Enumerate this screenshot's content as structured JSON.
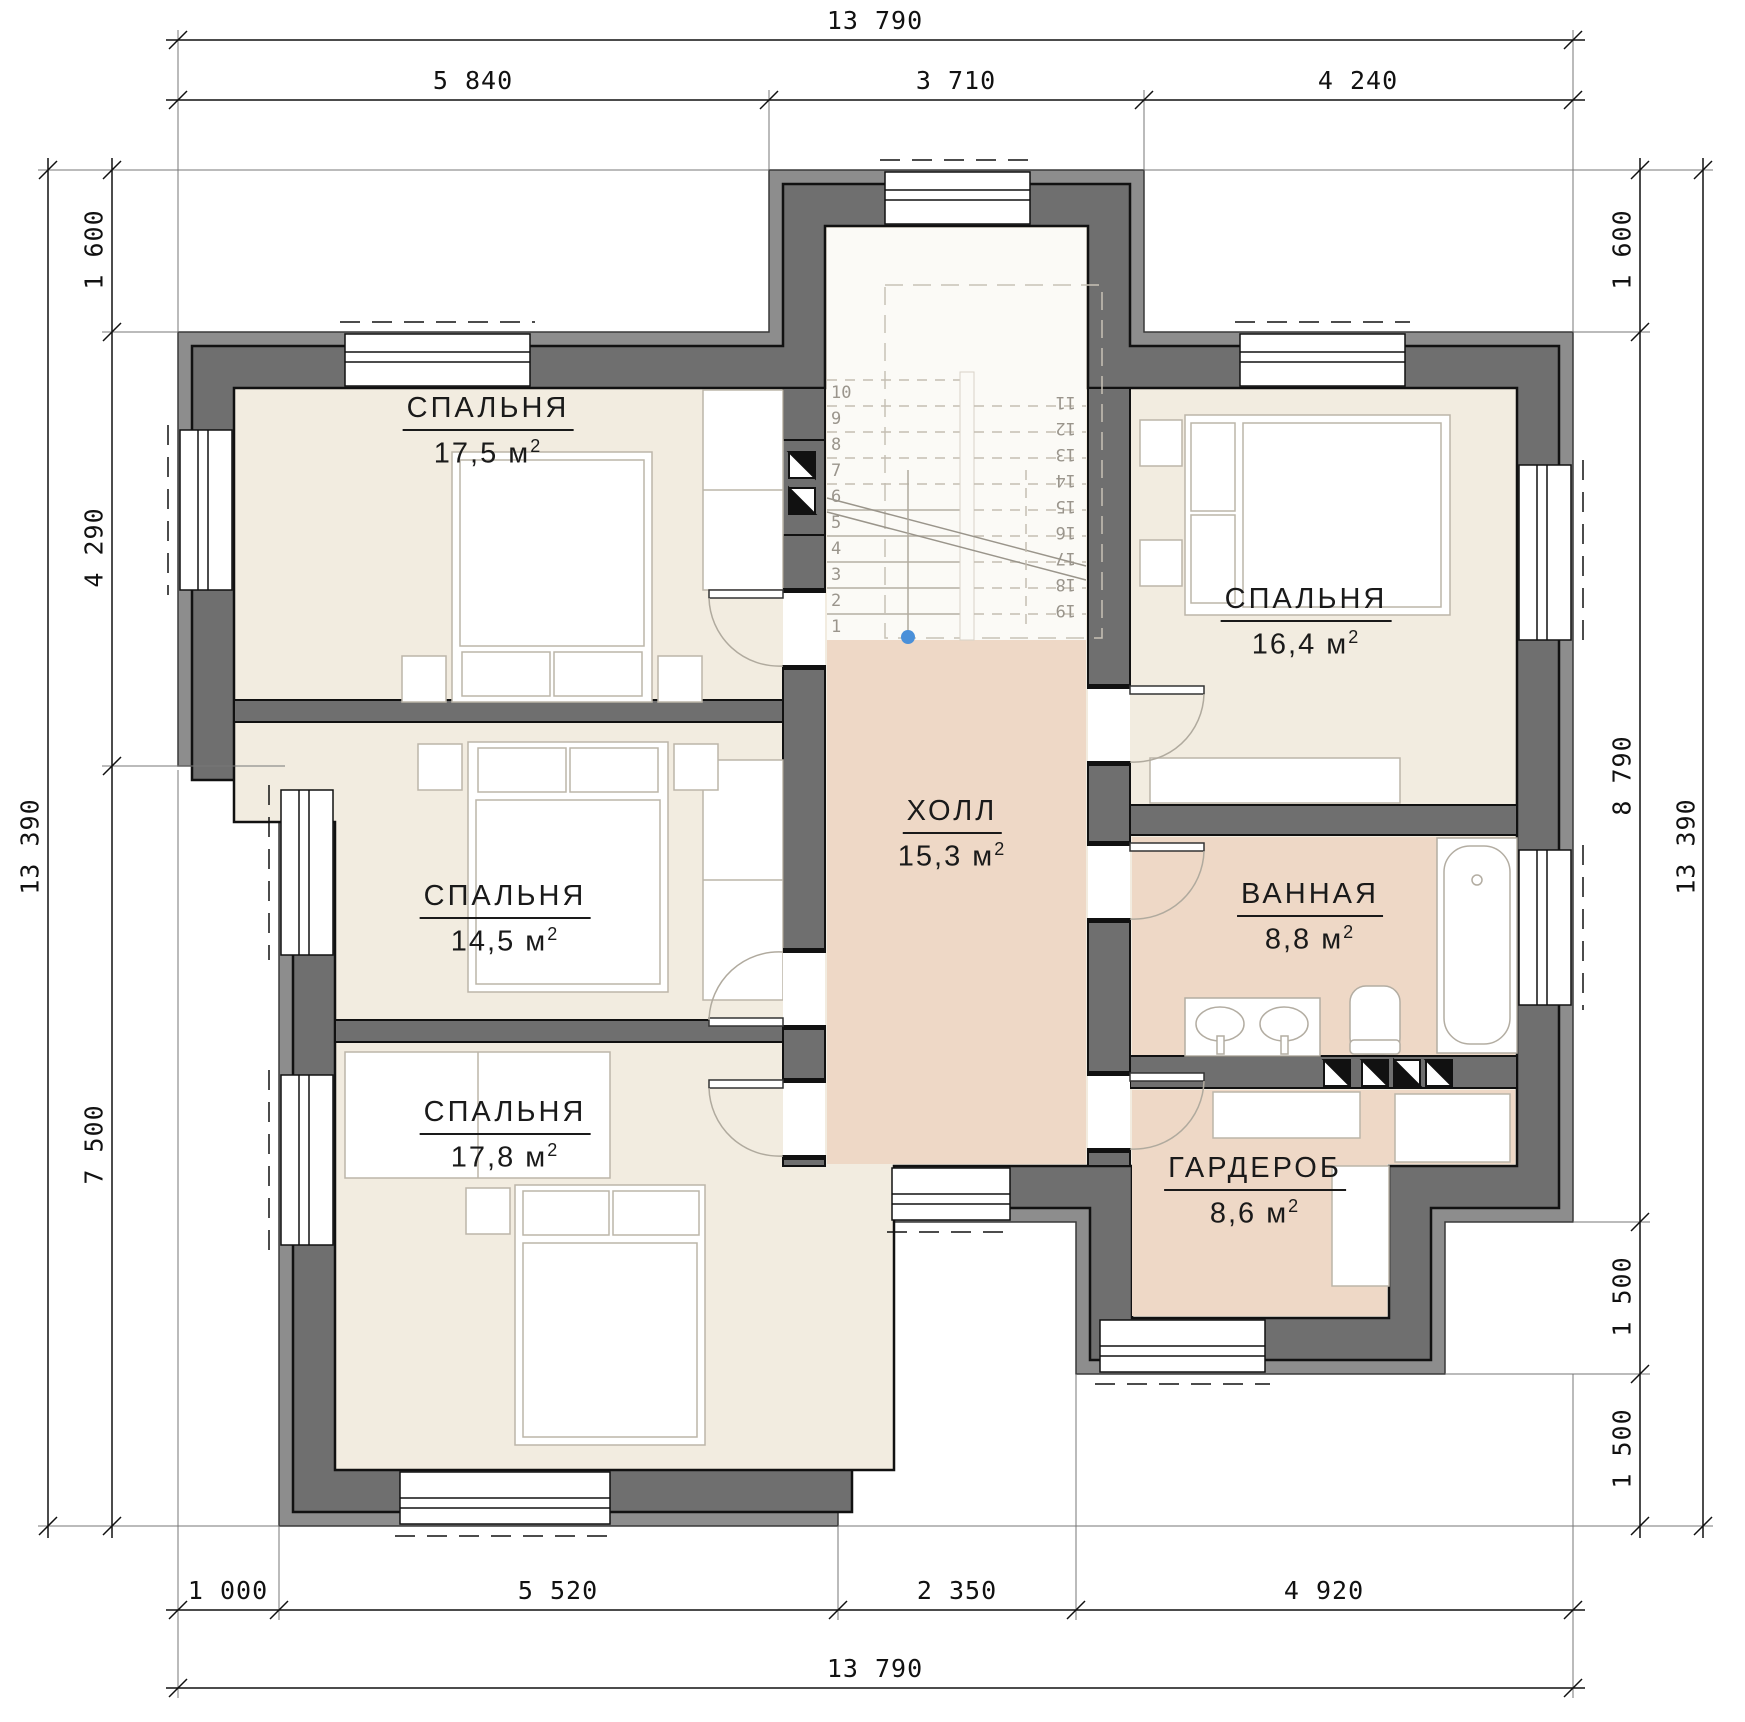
{
  "colors": {
    "wall": "#6f6f6f",
    "wall_band": "#8d8d8d",
    "outline": "#111111",
    "bedroom_floor": "#f2ece0",
    "hall_floor": "#eed8c6",
    "stair_floor": "#fbfaf6",
    "furniture_stroke": "#bcb5a9",
    "marker_blue": "#4a90d9"
  },
  "unit": {
    "symbol": "м",
    "exponent": "2"
  },
  "rooms": [
    {
      "id": "bedroom-top-left",
      "name": "СПАЛЬНЯ",
      "area": "17,5"
    },
    {
      "id": "bedroom-mid-left",
      "name": "СПАЛЬНЯ",
      "area": "14,5"
    },
    {
      "id": "bedroom-bottom-left",
      "name": "СПАЛЬНЯ",
      "area": "17,8"
    },
    {
      "id": "bedroom-top-right",
      "name": "СПАЛЬНЯ",
      "area": "16,4"
    },
    {
      "id": "hall",
      "name": "ХОЛЛ",
      "area": "15,3"
    },
    {
      "id": "bathroom",
      "name": "ВАННАЯ",
      "area": "8,8"
    },
    {
      "id": "wardrobe-room",
      "name": "ГАРДЕРОБ",
      "area": "8,6"
    }
  ],
  "dimensions": {
    "top_overall": "13 790",
    "top_segments": [
      "5 840",
      "3 710",
      "4 240"
    ],
    "bottom_segments": [
      "1 000",
      "5 520",
      "2 350",
      "4 920"
    ],
    "bottom_overall": "13 790",
    "left_segments": [
      "1 600",
      "4 290",
      "7 500"
    ],
    "left_overall": "13 390",
    "right_segments": [
      "1 600",
      "8 790",
      "1 500",
      "1 500"
    ],
    "right_overall": "13 390"
  },
  "stairs": {
    "up": [
      "1",
      "2",
      "3",
      "4",
      "5",
      "6",
      "7",
      "8",
      "9",
      "10"
    ],
    "down": [
      "11",
      "12",
      "13",
      "14",
      "15",
      "16",
      "17",
      "18",
      "19"
    ]
  }
}
